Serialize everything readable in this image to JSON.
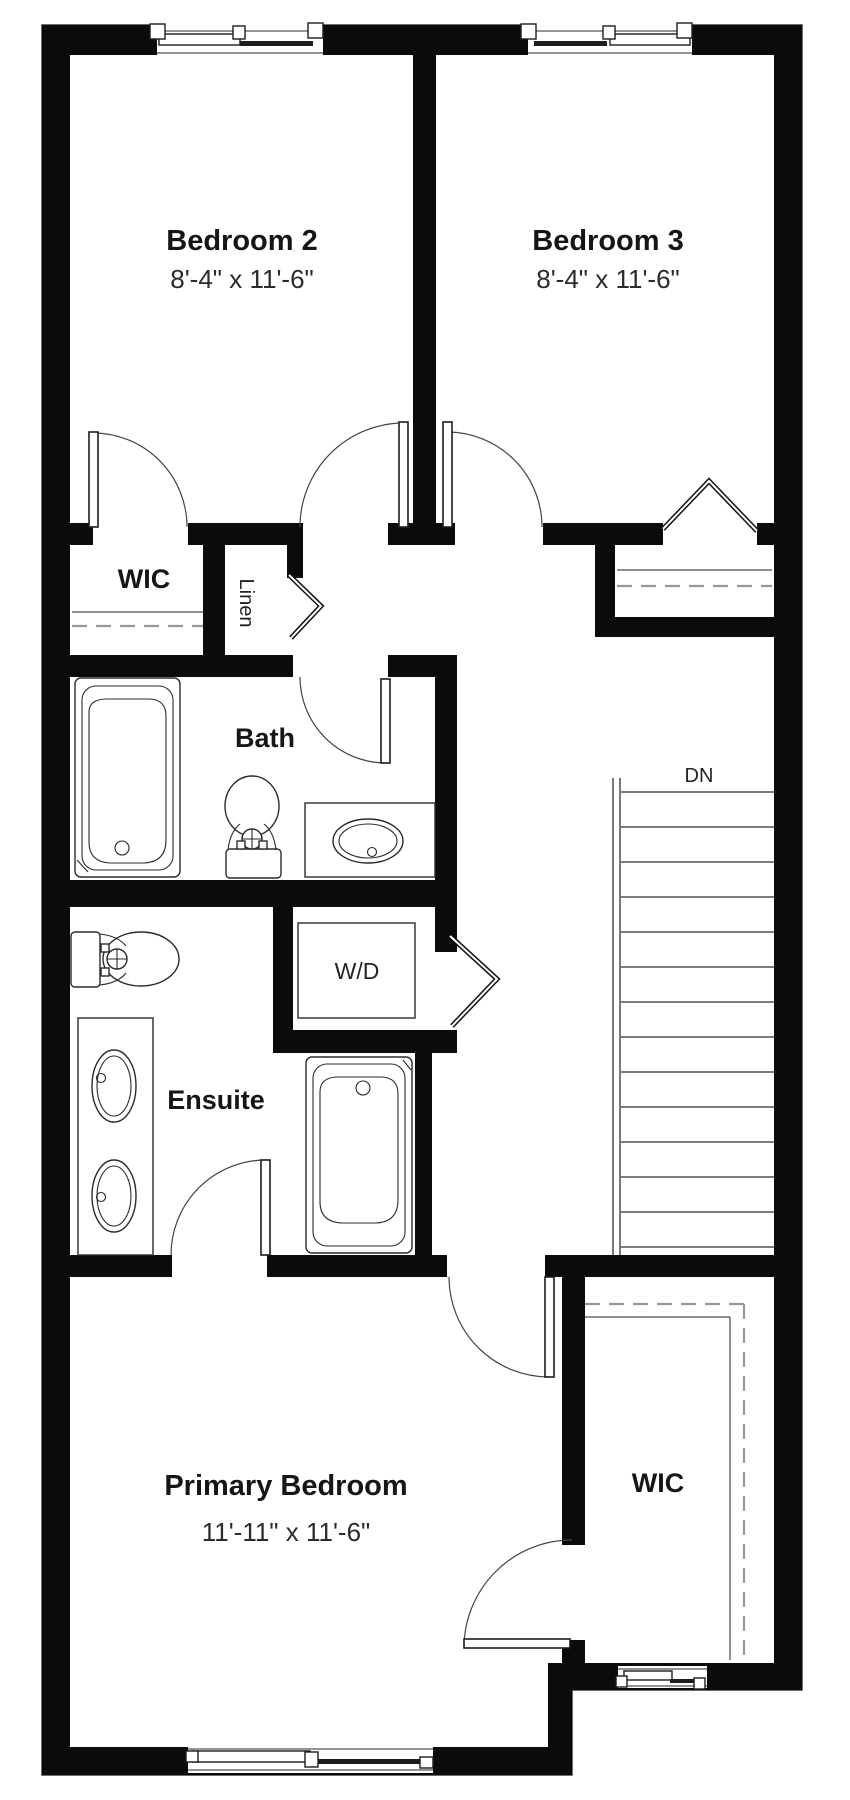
{
  "title": "Upper floor plan",
  "rooms": {
    "bedroom2": {
      "name": "Bedroom 2",
      "dims": "8'-4\" x 11'-6\""
    },
    "bedroom3": {
      "name": "Bedroom 3",
      "dims": "8'-4\" x 11'-6\""
    },
    "wic_upper": {
      "name": "WIC"
    },
    "linen": {
      "name": "Linen"
    },
    "bath": {
      "name": "Bath"
    },
    "wd": {
      "name": "W/D"
    },
    "ensuite": {
      "name": "Ensuite"
    },
    "primary": {
      "name": "Primary Bedroom",
      "dims": "11'-11\" x 11'-6\""
    },
    "wic_primary": {
      "name": "WIC"
    },
    "stairs": {
      "label": "DN"
    }
  },
  "colors": {
    "wall": "#0b0b0b",
    "fixture_line": "#2a2a2a",
    "closet_rod": "#979797",
    "text": "#161616",
    "background": "#ffffff"
  }
}
